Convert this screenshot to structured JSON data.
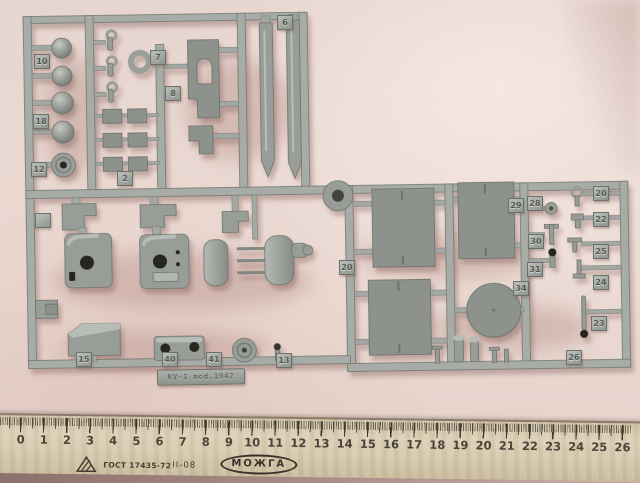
{
  "colors": {
    "background": "#e9d7d1",
    "plastic": "#a7aca6",
    "plastic_edge": "#737972",
    "part": "#989d97",
    "part_edge": "#6e746d",
    "hole": "#26261f",
    "ruler_wood": "#d6c9ad",
    "ruler_marks": "#3e382f",
    "floor_shadow": "#8b716b"
  },
  "sprue": {
    "plate_text": "KV-1 mod.1942",
    "part_tags": [
      {
        "label": "10",
        "x": 34,
        "y": 54
      },
      {
        "label": "18",
        "x": 33,
        "y": 114
      },
      {
        "label": "12",
        "x": 31,
        "y": 162
      },
      {
        "label": "7",
        "x": 150,
        "y": 50
      },
      {
        "label": "8",
        "x": 165,
        "y": 86
      },
      {
        "label": "2",
        "x": 117,
        "y": 171
      },
      {
        "label": "6",
        "x": 277,
        "y": 15
      },
      {
        "label": "",
        "x": 35,
        "y": 213
      },
      {
        "label": "20",
        "x": 339,
        "y": 260
      },
      {
        "label": "29",
        "x": 508,
        "y": 198
      },
      {
        "label": "28",
        "x": 527,
        "y": 196
      },
      {
        "label": "30",
        "x": 528,
        "y": 234
      },
      {
        "label": "31",
        "x": 527,
        "y": 262
      },
      {
        "label": "34",
        "x": 513,
        "y": 281
      },
      {
        "label": "20",
        "x": 593,
        "y": 186
      },
      {
        "label": "22",
        "x": 593,
        "y": 212
      },
      {
        "label": "25",
        "x": 593,
        "y": 244
      },
      {
        "label": "24",
        "x": 593,
        "y": 275
      },
      {
        "label": "23",
        "x": 591,
        "y": 316
      },
      {
        "label": "26",
        "x": 566,
        "y": 350
      },
      {
        "label": "15",
        "x": 76,
        "y": 352
      },
      {
        "label": "40",
        "x": 162,
        "y": 352
      },
      {
        "label": "41",
        "x": 206,
        "y": 352
      },
      {
        "label": "13",
        "x": 276,
        "y": 353
      }
    ]
  },
  "ruler": {
    "unit_labels": [
      "0",
      "1",
      "2",
      "3",
      "4",
      "5",
      "6",
      "7",
      "8",
      "9",
      "10",
      "11",
      "12",
      "13",
      "14",
      "15",
      "16",
      "17",
      "18",
      "19",
      "20",
      "21",
      "22",
      "23",
      "24",
      "25",
      "26"
    ],
    "standard": "ГОСТ 17435-72",
    "code": "II-08",
    "brand": "МОЖГА"
  }
}
